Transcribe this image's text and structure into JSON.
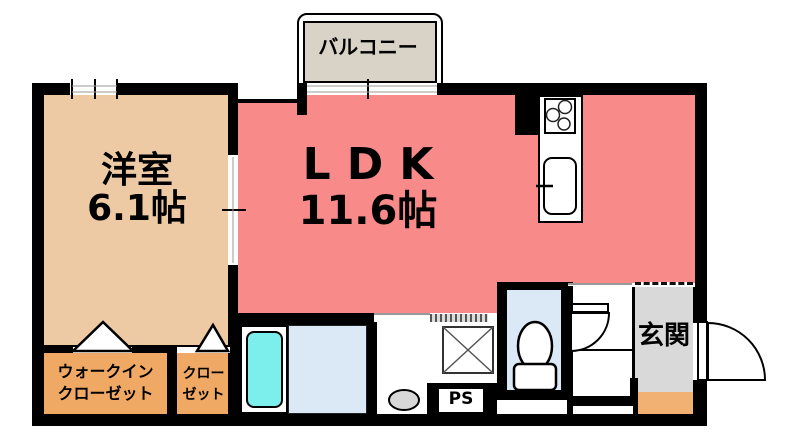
{
  "rooms": {
    "balcony": {
      "label": "バルコニー"
    },
    "western_room": {
      "name": "洋室",
      "size": "6.1帖"
    },
    "ldk": {
      "name": "LDK",
      "size": "11.6帖"
    },
    "walk_in_closet": {
      "line1": "ウォークイン",
      "line2": "クローゼット"
    },
    "closet": {
      "line1": "クロー",
      "line2": "ゼット"
    },
    "entrance": {
      "label": "玄関"
    },
    "pipe_space": {
      "label": "PS"
    }
  },
  "colors": {
    "wall": "#000000",
    "ldk": "#f98a8a",
    "western_room": "#edcaa4",
    "closet": "#f0a965",
    "entrance_floor": "#d9d9d9",
    "entrance_step": "#f0b172",
    "balcony": "#d9d3c7",
    "wet_room": "#dbe9f6",
    "bathtub": "#7ceeec",
    "fixture_gray": "#d8d8d8"
  },
  "icons": {
    "stove": "gas-stove-icon",
    "sink": "kitchen-sink-icon",
    "bathtub": "bathtub-icon",
    "washing_machine": "washing-machine-space-icon",
    "toilet": "toilet-icon",
    "entrance_door": "entrance-door-swing-icon",
    "interior_door": "door-swing-icon",
    "closet_doors": "closet-door-triangle-icon",
    "drain": "oval-fixture-icon",
    "window": "sliding-window-icon"
  }
}
